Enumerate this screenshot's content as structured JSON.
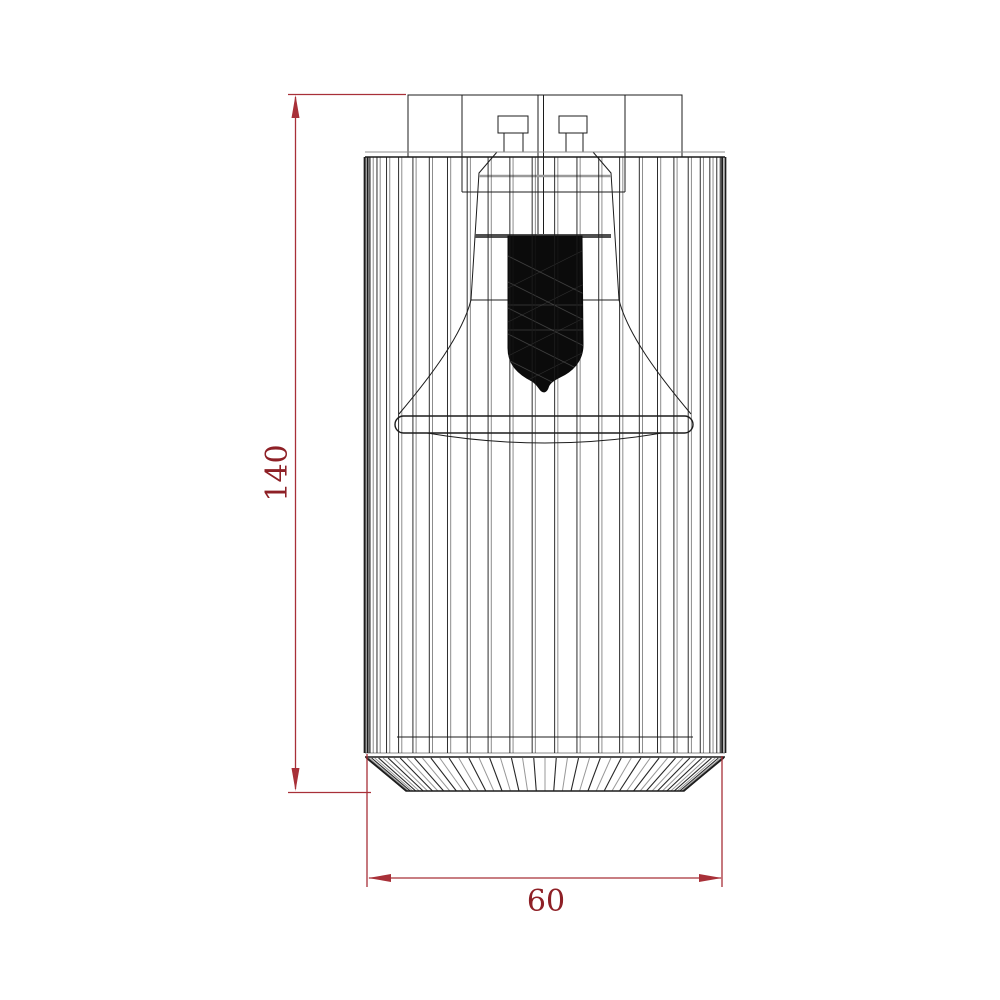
{
  "page": {
    "background": "#ffffff"
  },
  "diagram": {
    "type": "technical-drawing",
    "view": "front-elevation-wireframe",
    "subject": "cylindrical wire-cage lamp fixture with internal bulb and reflector shade",
    "dimensions": {
      "height": {
        "value": "140",
        "orientation": "vertical"
      },
      "width": {
        "value": "60",
        "orientation": "horizontal"
      }
    },
    "colors": {
      "dimension-line": "#a83038",
      "dimension-text": "#8e2026",
      "line-dark": "#1c1c1c",
      "line-light": "#8c8c8c",
      "bulb-fill": "#0b0b0b",
      "background": "#ffffff"
    }
  }
}
